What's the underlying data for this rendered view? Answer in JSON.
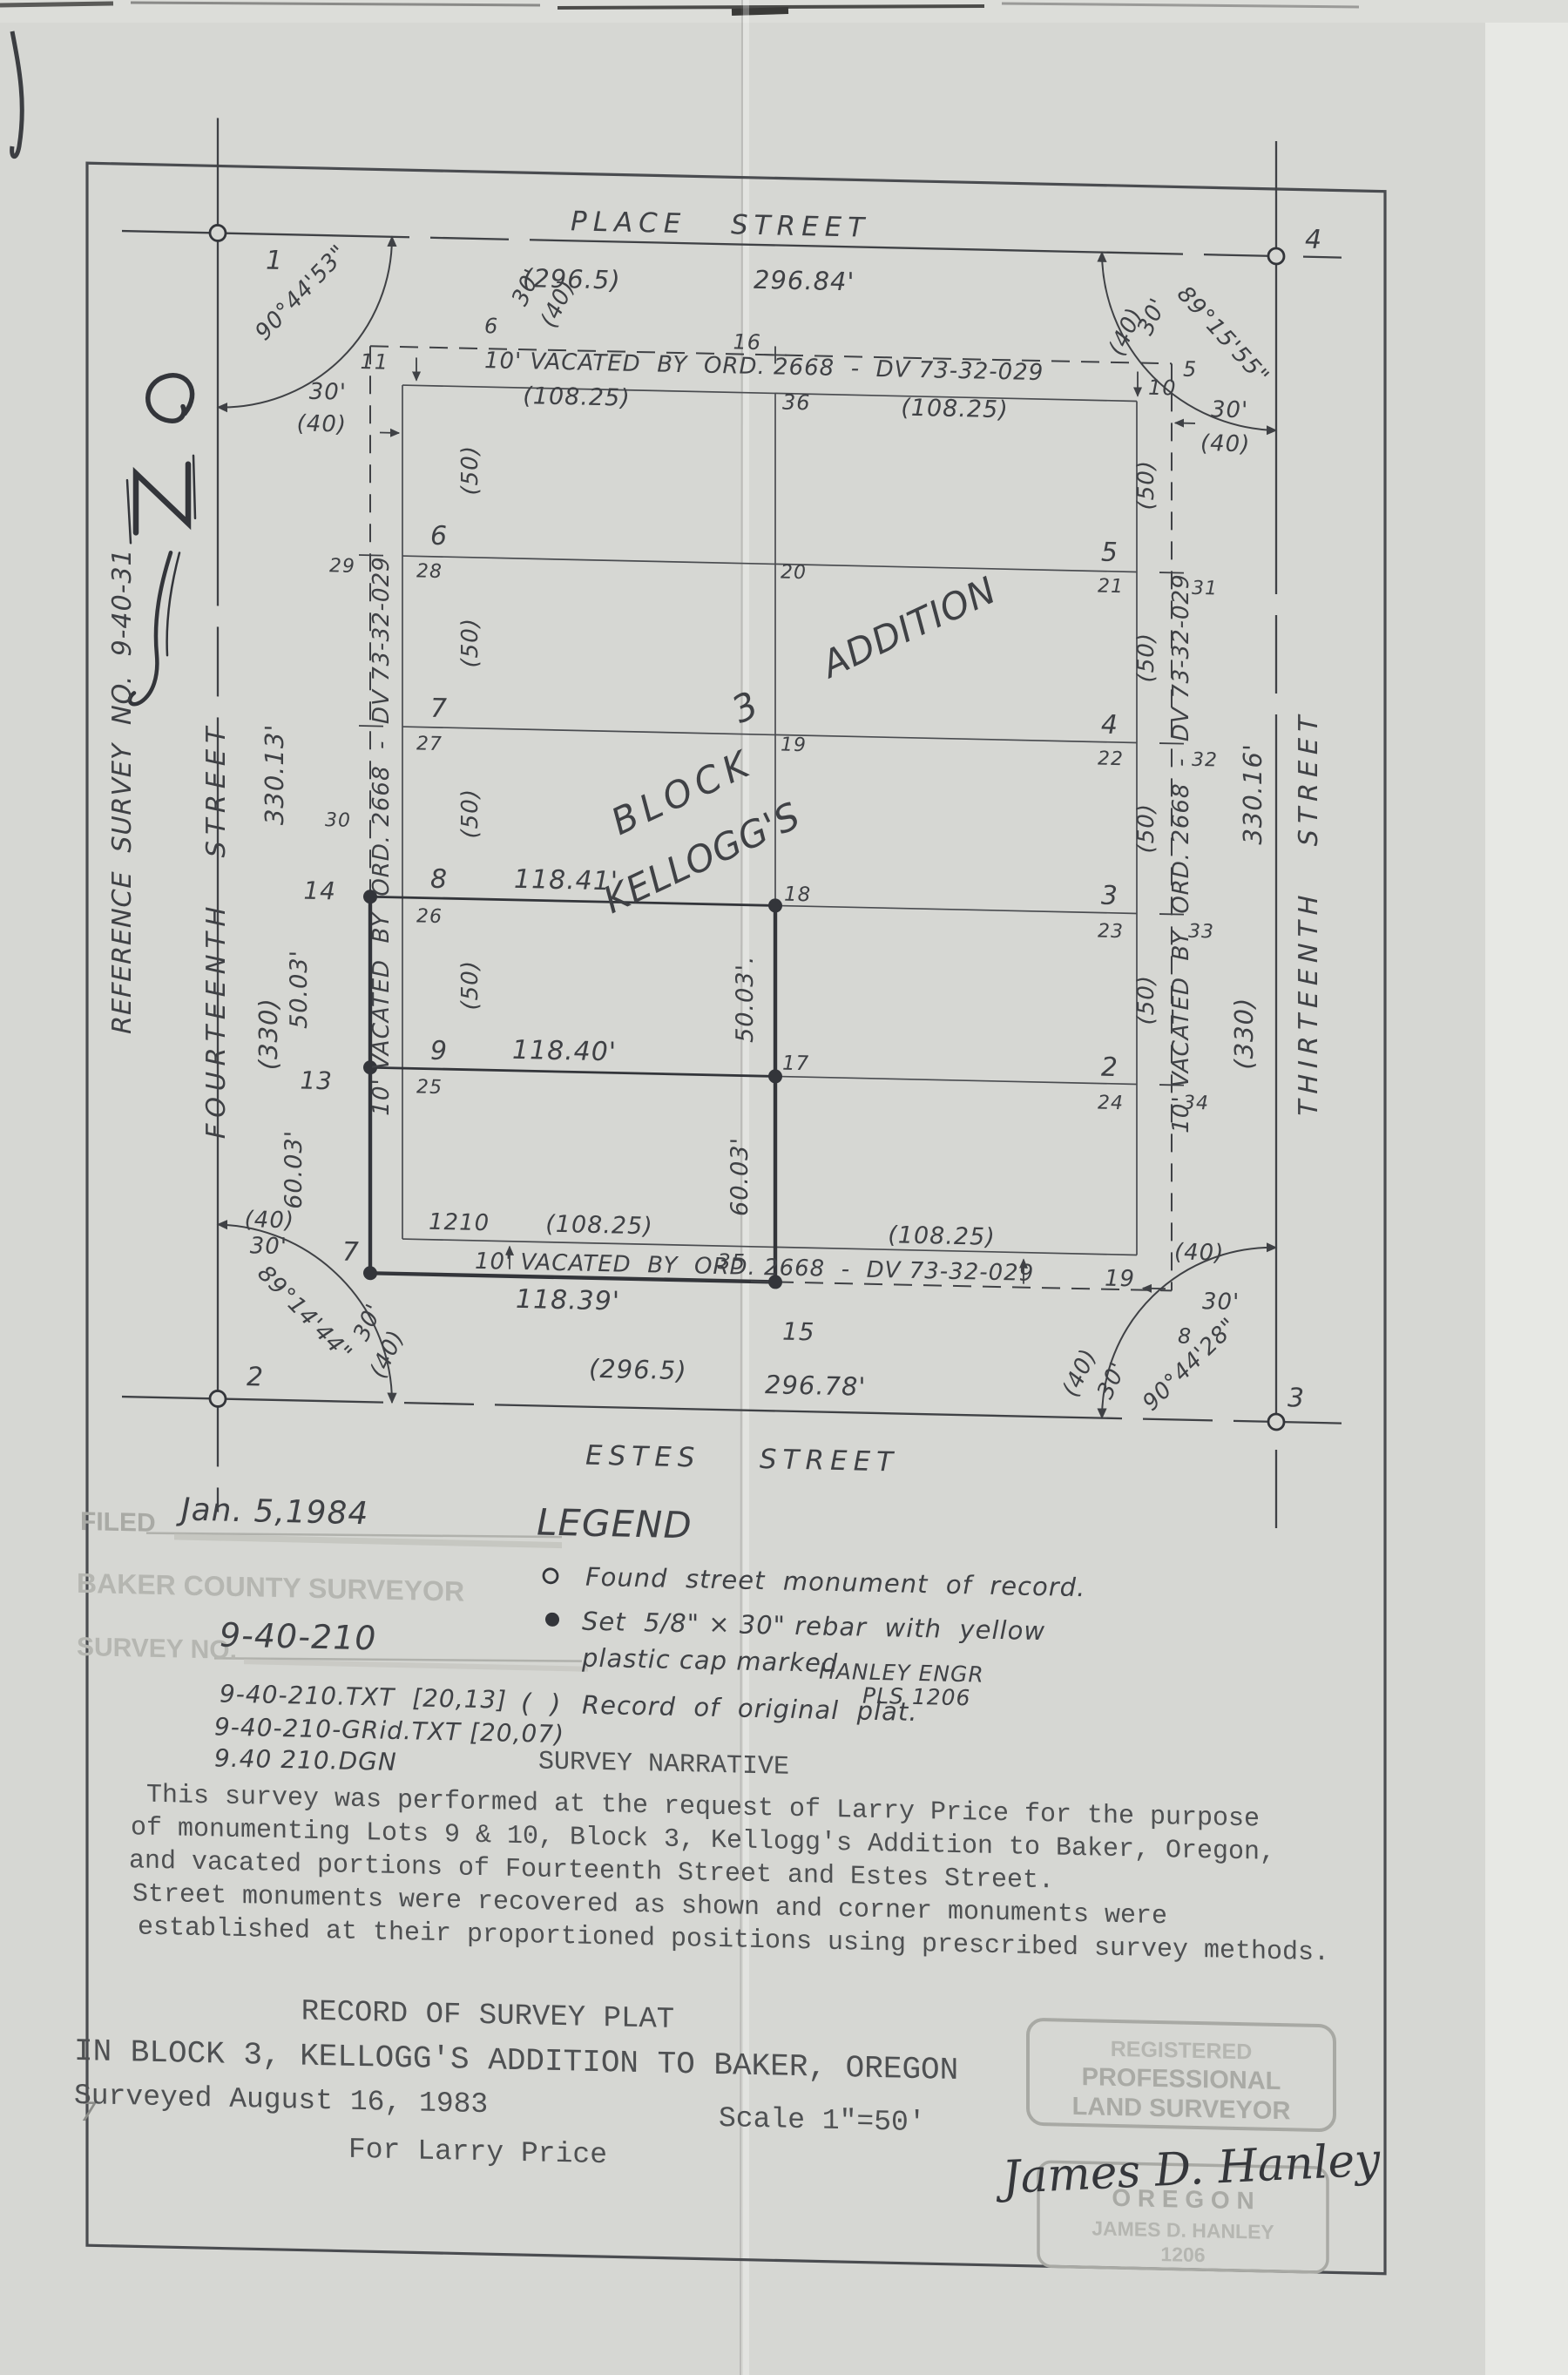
{
  "plat": {
    "streets": {
      "place": {
        "name": "PLACE   STREET",
        "record": "(296.5)",
        "measured": "296.84'"
      },
      "estes": {
        "name": "ESTES    STREET",
        "record": "(296.5)",
        "measured": "296.78'"
      },
      "fourteenth": {
        "name": "FOURTEENTH   STREET",
        "record": "(330)",
        "measured": "330.13'"
      },
      "thirteenth": {
        "name": "THIRTEENTH   STREET",
        "record": "(330)",
        "measured": "330.16'"
      }
    },
    "reference": "REFERENCE  SURVEY  NO.  9-40-31",
    "block": {
      "word1": "BLOCK",
      "number": "3",
      "word2": "KELLOGG'S",
      "word3": "ADDITION"
    },
    "vacated": "10' VACATED  BY  ORD. 2668  -  DV 73-32-029",
    "angles": {
      "nw": "90°44'53\"",
      "ne": "89°15'55\"",
      "sw": "89°14'44\"",
      "se": "90°44'28\""
    },
    "points": {
      "p1": "1",
      "p2": "2",
      "p3": "3",
      "p4": "4",
      "p7": "7",
      "p13": "13",
      "p14": "14",
      "p15": "15",
      "p17": "17",
      "p18": "18"
    },
    "ticks": {
      "t5": "5",
      "t6": "6",
      "t8": "8",
      "t10": "10",
      "t11": "11",
      "t16": "16",
      "t19": "19",
      "t19m": "19",
      "t20": "20",
      "t21": "21",
      "t22": "22",
      "t23": "23",
      "t24": "24",
      "t25": "25",
      "t26": "26",
      "t27": "27",
      "t28": "28",
      "t29": "29",
      "t30": "30",
      "t31": "31",
      "t32": "32",
      "t33": "33",
      "t34": "34",
      "t35": "35",
      "t36": "36",
      "t1210": "1210"
    },
    "lots": {
      "l2": "2",
      "l3": "3",
      "l4": "4",
      "l5": "5",
      "l6": "6",
      "l7": "7",
      "l8": "8",
      "l9": "9"
    },
    "dims": {
      "d118_41": "118.41'",
      "d118_40": "118.40'",
      "d118_39": "118.39'",
      "r108": "(108.25)",
      "r50": "(50)",
      "m50": "50.03'",
      "m50p": "50.03'.",
      "m60": "60.03'",
      "w30": "30'",
      "w40": "(40)"
    }
  },
  "legend": {
    "title": "LEGEND",
    "found": "Found  street  monument  of  record.",
    "set1": "Set  5/8\" × 30\" rebar  with  yellow",
    "set2": "plastic cap marked",
    "cap1": "HANLEY ENGR",
    "cap2": "PLS 1206",
    "paren": "(  )",
    "record": "Record  of  original  plat."
  },
  "filed": {
    "label": "FILED",
    "date": "Jan. 5,1984",
    "office": "BAKER COUNTY SURVEYOR",
    "survey_no_label": "SURVEY NO.",
    "survey_no": "9-40-210",
    "note1": "9-40-210.TXT  [20,13]",
    "note2": "9-40-210-GRid.TXT [20,07)",
    "note3": "9.40 210.DGN",
    "pencil": "7"
  },
  "narrative": {
    "title": "SURVEY NARRATIVE",
    "line1": "This survey was performed at the request of Larry Price for the purpose",
    "line2": "of monumenting Lots 9 & 10, Block 3, Kellogg's Addition to Baker, Oregon,",
    "line3": "and vacated portions of Fourteenth Street and Estes Street.",
    "line4": "Street monuments were recovered as shown and corner monuments were",
    "line5": "established at their proportioned positions using prescribed survey methods."
  },
  "title_block": {
    "line1": "RECORD OF SURVEY PLAT",
    "line2": "IN BLOCK 3, KELLOGG'S ADDITION TO BAKER, OREGON",
    "surveyed": "Surveyed August 16, 1983",
    "scale": "Scale 1\"=50'",
    "client": "For Larry Price"
  },
  "stamp": {
    "l1": "REGISTERED",
    "l2": "PROFESSIONAL",
    "l3": "LAND SURVEYOR",
    "signature": "James D. Hanley",
    "state": "O R E G O N",
    "name": "JAMES D. HANLEY",
    "number": "1206"
  },
  "colors": {
    "ink": "#3f4145",
    "faded_stamp": "#a9aaa5",
    "paper": "#d6d7d3"
  }
}
